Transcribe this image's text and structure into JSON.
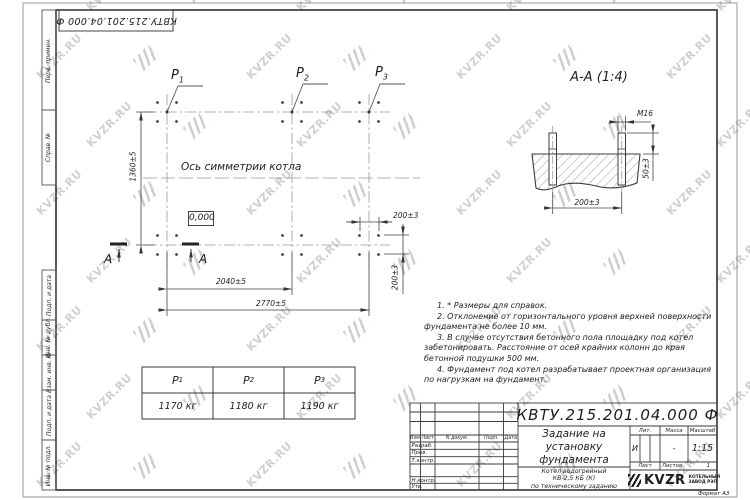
{
  "top_stamp": "КВТУ.215.201.04.000 Ф",
  "side_strip": {
    "items": [
      "Перв. примен.",
      "Справ. №",
      "Подп. и дата",
      "Инв. № дубл.",
      "Взам. инв. №",
      "Подп. и дата",
      "Инв. № подл."
    ]
  },
  "plan": {
    "point_labels": [
      {
        "base": "Р",
        "sub": "1"
      },
      {
        "base": "Р",
        "sub": "2"
      },
      {
        "base": "Р",
        "sub": "3"
      }
    ],
    "symmetry_label": "Ось симметрии котла",
    "level_mark": "0,000",
    "dim_height": "1360±5",
    "dim_span_mid": "2040±5",
    "dim_span_total": "2770±5",
    "dim_bolt_x": "200±3",
    "dim_bolt_y": "200±3",
    "section_letter": "А"
  },
  "section_view": {
    "title": "А-А (1:4)",
    "dim_thread": "М16",
    "dim_height": "50±3",
    "dim_spacing": "200±3"
  },
  "load_table": {
    "columns": [
      {
        "base": "Р",
        "sub": "1",
        "value": "1170 кг"
      },
      {
        "base": "Р",
        "sub": "2",
        "value": "1180 кг"
      },
      {
        "base": "Р",
        "sub": "3",
        "value": "1190 кг"
      }
    ]
  },
  "notes": [
    "1. * Размеры для справок.",
    "2. Отклонение от горизонтального уровня верхней поверхности фундамента не более 10 мм.",
    "3. В случае отсутствия бетонного пола площадку под котел забетонировать. Расстояние от осей крайних колонн до края бетонной подушки 500 мм.",
    "4. Фундамент под котел разрабатывает проектная организация по нагрузкам на фундамент."
  ],
  "title_block": {
    "doc_number": "КВТУ.215.201.04.000 Ф",
    "title_lines": [
      "Задание на",
      "установку",
      "фундамента"
    ],
    "subtitle_lines": [
      "Котел водогрейный",
      "КВ-2,5 КБ (К)",
      "по техническому заданию"
    ],
    "header_cols": [
      "Изм.",
      "Лист",
      "N докум.",
      "Подп.",
      "Дата"
    ],
    "rows": [
      "Разраб.",
      "Пров.",
      "Т.контр.",
      "Н.контр.",
      "Утв."
    ],
    "lit_label": "Лит.",
    "lit_value": "И",
    "mass_label": "Масса",
    "mass_value": "-",
    "scale_label": "Масштаб",
    "scale_value": "1:15",
    "sheet_label": "Лист",
    "sheets_label": "Листов",
    "sheets_value": "1",
    "company": "KVZR",
    "company_line1": "КОТЕЛЬНЫЙ",
    "company_line2": "ЗАВОД РЭП",
    "format": "Формат А3"
  },
  "watermark": {
    "text": "KVZR.RU"
  }
}
